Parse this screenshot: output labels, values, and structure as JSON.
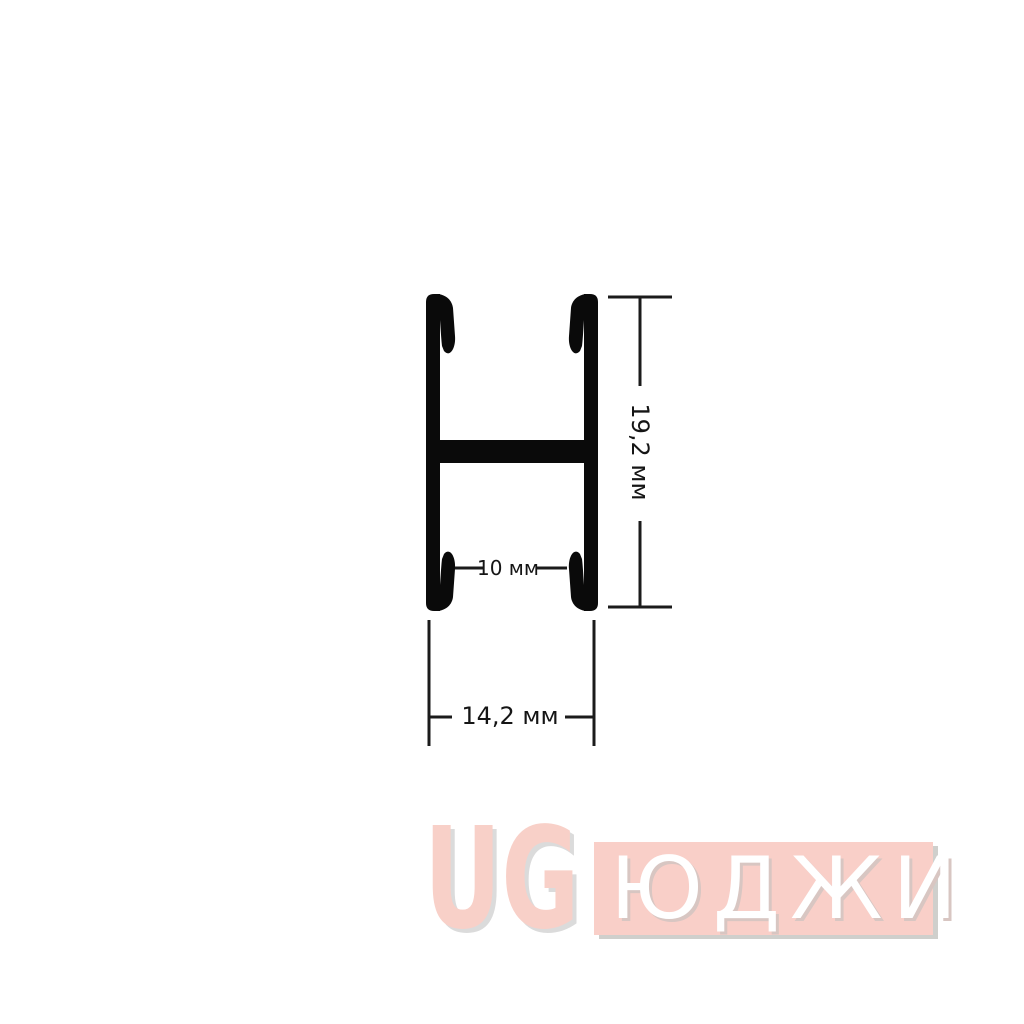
{
  "page": {
    "background": "#ffffff"
  },
  "drawing": {
    "description": "H-shaped aluminium profile cross-section with dimension lines",
    "profile_color": "#0a0a0a",
    "dim_line_color": "#1b1b1b",
    "dim_text_color": "#151515",
    "labels": {
      "height": "19,2 мм",
      "inner_width": "10 мм",
      "outer_width": "14,2 мм"
    }
  },
  "watermark": {
    "logo": "UG",
    "brand": "ЮДЖИ",
    "logo_color": "#f8d0c8",
    "logo_shadow": "#dbdbdb",
    "panel_color": "#f9cfc8",
    "panel_shadow": "#cfcfcc",
    "brand_text_color": "#ffffff"
  }
}
